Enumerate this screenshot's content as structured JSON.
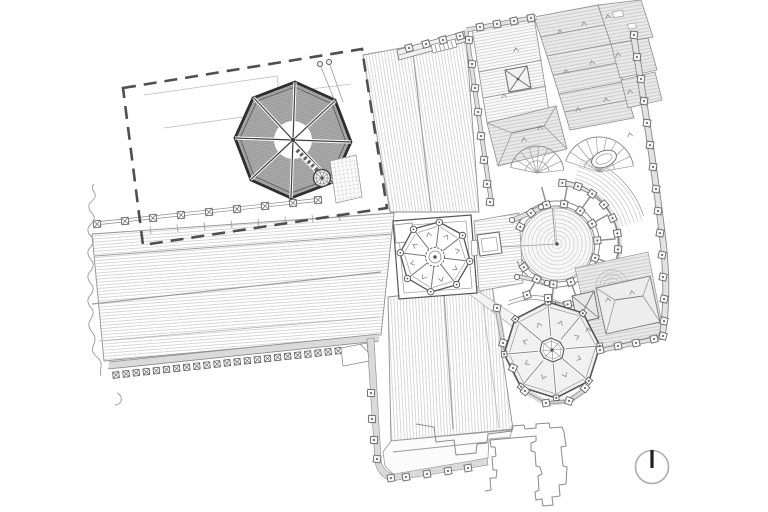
{
  "meta": {
    "title": "",
    "kind": "architectural roof plan",
    "description": "Monochrome line-drawing roof plan of a gothic cathedral precinct: long hatched nave, crossing with octagonal lantern, north and south transepts, chevet with conical apse roof and radiating flying buttresses, dark octagonal chapter-house roof inside a dashed site boundary, north-east wing of grey hipped roofs, east precinct wall with buttress piers, south-east octagonal chapel, cloister ruin outline, and a north arrow."
  },
  "colors": {
    "background": "#ffffff",
    "line_dark": "#2e2e2e",
    "line_medium": "#7a7a7a",
    "line_light": "#c7c7c7",
    "dark_roof_fill": "#ababab",
    "gray_roof_fill": "#e9e9e9",
    "parapet_fill": "#dadada",
    "boundary_dash": "#4f4f4f",
    "compass_ring": "#adadad",
    "compass_needle": "#1f1f1f"
  },
  "compass": {
    "icon": "north-arrow-icon",
    "direction": "up"
  },
  "plan": {
    "features": [
      {
        "name": "site-boundary",
        "style": "dashed rectangle"
      },
      {
        "name": "chapter-house-octagon",
        "style": "dark hatched octagonal roof with radial ridges, central oculus, stair turret, dotted access ladder"
      },
      {
        "name": "garden-fence",
        "style": "post-and-rail line with nine x-braced posts"
      },
      {
        "name": "nave-roof",
        "style": "long hatched roof with ridge lines and south parapet of x-braced merlons"
      },
      {
        "name": "north-transept-roof",
        "style": "hatched roof with gable-end gallery strip"
      },
      {
        "name": "south-transept-roof",
        "style": "hatched roof with south apron and pier parapet"
      },
      {
        "name": "crossing-lantern",
        "style": "octagonal lantern with corner pinnacles on square base"
      },
      {
        "name": "choir-roof",
        "style": "short hatched roof with gabled skylight"
      },
      {
        "name": "chevet",
        "style": "conical apse roof, horseshoe pier ring, radiating flying buttresses, outer ambulatory arcs"
      },
      {
        "name": "northeast-wing-roofs",
        "style": "grey hipped roof strips, x-marked skylight, two fan stairs, oval skylight"
      },
      {
        "name": "east-precinct-wall",
        "style": "curved double wall with fifteen buttress piers"
      },
      {
        "name": "southeast-chapel-octagon",
        "style": "octagonal roof with lantern, pinnacles and parapet"
      },
      {
        "name": "southeast-annex-roofs",
        "style": "grey hip roof, pyramid skylight, domed chapel contours"
      },
      {
        "name": "cloister-outline",
        "style": "jagged stepped outline of unroofed ruin"
      },
      {
        "name": "terrain-break-line",
        "style": "wavy torn-edge cut line on west side"
      },
      {
        "name": "north-arrow",
        "style": "circle with vertical needle"
      }
    ]
  }
}
